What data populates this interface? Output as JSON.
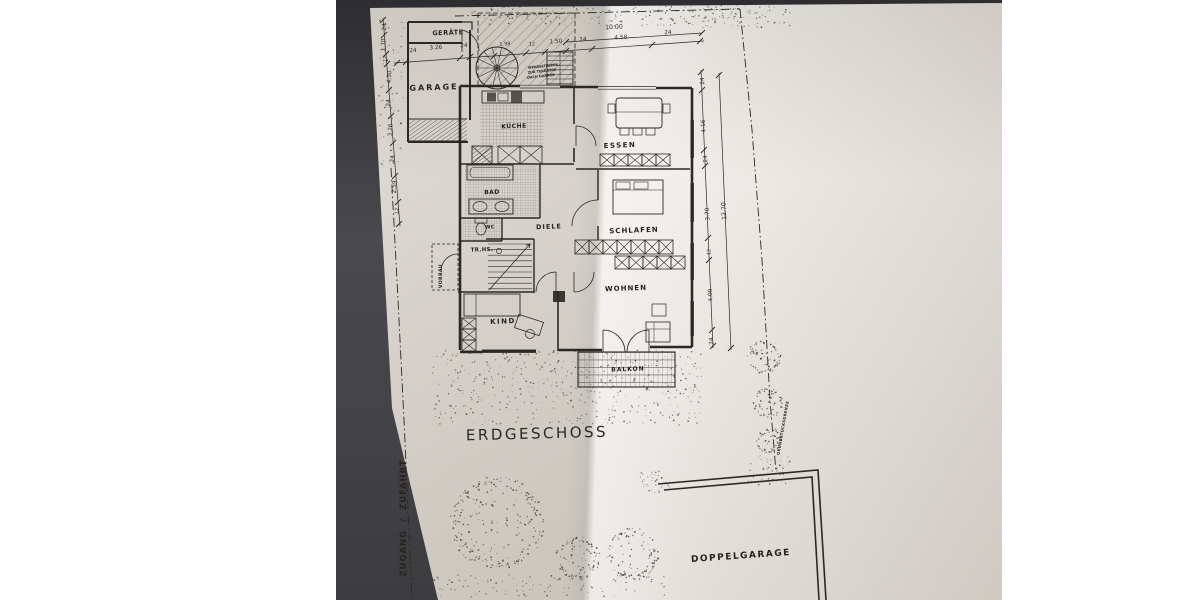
{
  "title": {
    "text": "ERDGESCHOSS"
  },
  "ink_color": "#2b2924",
  "paper_color": "#e7e4de",
  "room_labels": [
    {
      "id": "geraete",
      "text": "GERÄTE",
      "x": 448,
      "y": 33,
      "fs": 6.5,
      "rot": -2,
      "ls": 0.5
    },
    {
      "id": "garage",
      "text": "GARAGE",
      "x": 434,
      "y": 88,
      "fs": 8,
      "rot": -2,
      "ls": 2
    },
    {
      "id": "kueche",
      "text": "KÜCHE",
      "x": 514,
      "y": 127,
      "fs": 6,
      "rot": -2,
      "ls": 0.5
    },
    {
      "id": "essen",
      "text": "ESSEN",
      "x": 620,
      "y": 146,
      "fs": 7,
      "rot": -2,
      "ls": 1.5
    },
    {
      "id": "bad",
      "text": "BAD",
      "x": 492,
      "y": 193,
      "fs": 6,
      "rot": -2,
      "ls": 0.5
    },
    {
      "id": "wc",
      "text": "WC",
      "x": 490,
      "y": 228,
      "fs": 5,
      "rot": -2,
      "ls": 0.3
    },
    {
      "id": "diele",
      "text": "DIELE",
      "x": 549,
      "y": 227,
      "fs": 6.5,
      "rot": -2,
      "ls": 1
    },
    {
      "id": "treppenhaus",
      "text": "TR.HS.",
      "x": 482,
      "y": 251,
      "fs": 5.5,
      "rot": -2,
      "ls": 0.3
    },
    {
      "id": "schlafen",
      "text": "SCHLAFEN",
      "x": 634,
      "y": 231,
      "fs": 7,
      "rot": -2,
      "ls": 1
    },
    {
      "id": "wohnen",
      "text": "WOHNEN",
      "x": 626,
      "y": 289,
      "fs": 7,
      "rot": -2,
      "ls": 1
    },
    {
      "id": "kind",
      "text": "KIND",
      "x": 503,
      "y": 322,
      "fs": 7,
      "rot": -2,
      "ls": 1.5
    },
    {
      "id": "balkon",
      "text": "BALKON",
      "x": 628,
      "y": 370,
      "fs": 6,
      "rot": -2,
      "ls": 1
    },
    {
      "id": "vorbau",
      "text": "VORBAU",
      "x": 442,
      "y": 276,
      "fs": 4.5,
      "rot": -90,
      "ls": 0.5
    },
    {
      "id": "doppelgarage",
      "text": "DOPPELGARAGE",
      "x": 741,
      "y": 557,
      "fs": 9,
      "rot": -4,
      "ls": 1.5
    },
    {
      "id": "zugang-zufahrt",
      "text": "ZUGANG  /  ZUFAHRT",
      "x": 404,
      "y": 518,
      "fs": 8.5,
      "rot": -90,
      "ls": 1
    },
    {
      "id": "grundstuecksgrenze",
      "text": "GRUNDSTÜCKSGRENZE",
      "x": 783,
      "y": 428,
      "fs": 3.8,
      "rot": -80,
      "ls": 0.3
    },
    {
      "id": "wendeltreppe-1",
      "text": "WENDELTREPPE",
      "x": 543,
      "y": 67,
      "fs": 3.4,
      "rot": -6,
      "ls": 0
    },
    {
      "id": "wendeltreppe-2",
      "text": "ZUR TERRASSE",
      "x": 542,
      "y": 72,
      "fs": 3.4,
      "rot": -6,
      "ls": 0
    },
    {
      "id": "wendeltreppe-3",
      "text": "DACH GARAGE",
      "x": 541,
      "y": 77,
      "fs": 3.4,
      "rot": -6,
      "ls": 0
    }
  ],
  "dim_labels": [
    {
      "text": "10.00",
      "x": 614,
      "y": 28,
      "fs": 6.2,
      "rot": -3
    },
    {
      "text": "24",
      "x": 413,
      "y": 52,
      "fs": 5.8,
      "rot": -3
    },
    {
      "text": "3.26",
      "x": 436,
      "y": 49,
      "fs": 5.8,
      "rot": -3
    },
    {
      "text": "24",
      "x": 464,
      "y": 47,
      "fs": 5.8,
      "rot": -3
    },
    {
      "text": "1.98",
      "x": 505,
      "y": 45,
      "fs": 5,
      "rot": -3
    },
    {
      "text": "12",
      "x": 532,
      "y": 45,
      "fs": 5,
      "rot": -3
    },
    {
      "text": "1.50",
      "x": 556,
      "y": 43,
      "fs": 5.8,
      "rot": -3
    },
    {
      "text": "24",
      "x": 583,
      "y": 41,
      "fs": 5.8,
      "rot": -3
    },
    {
      "text": "4.58",
      "x": 621,
      "y": 39,
      "fs": 5.8,
      "rot": -3
    },
    {
      "text": "24",
      "x": 668,
      "y": 34,
      "fs": 5.8,
      "rot": -3
    },
    {
      "text": "24",
      "x": 386,
      "y": 27,
      "fs": 5.8,
      "rot": -87
    },
    {
      "text": "1.70",
      "x": 385,
      "y": 45,
      "fs": 5.8,
      "rot": -87
    },
    {
      "text": "12",
      "x": 386,
      "y": 59,
      "fs": 5,
      "rot": -87
    },
    {
      "text": "4.30",
      "x": 391,
      "y": 77,
      "fs": 5.8,
      "rot": -87
    },
    {
      "text": "24",
      "x": 390,
      "y": 103,
      "fs": 5.8,
      "rot": -87
    },
    {
      "text": "3.26",
      "x": 392,
      "y": 130,
      "fs": 5.8,
      "rot": -87
    },
    {
      "text": "24",
      "x": 394,
      "y": 159,
      "fs": 5.8,
      "rot": -87
    },
    {
      "text": "2.59",
      "x": 396,
      "y": 187,
      "fs": 5.8,
      "rot": -87
    },
    {
      "text": "12",
      "x": 398,
      "y": 211,
      "fs": 5,
      "rot": -87
    },
    {
      "text": "24",
      "x": 704,
      "y": 81,
      "fs": 5.8,
      "rot": -93
    },
    {
      "text": "4.16",
      "x": 705,
      "y": 126,
      "fs": 5.8,
      "rot": -93
    },
    {
      "text": "24",
      "x": 707,
      "y": 159,
      "fs": 5.8,
      "rot": -93
    },
    {
      "text": "3.70",
      "x": 709,
      "y": 214,
      "fs": 5.8,
      "rot": -93
    },
    {
      "text": "12",
      "x": 710,
      "y": 252,
      "fs": 5,
      "rot": -93
    },
    {
      "text": "4.00",
      "x": 712,
      "y": 295,
      "fs": 5.8,
      "rot": -93
    },
    {
      "text": "24",
      "x": 713,
      "y": 341,
      "fs": 5.8,
      "rot": -93
    },
    {
      "text": "12.70",
      "x": 725,
      "y": 211,
      "fs": 6.2,
      "rot": -93
    }
  ]
}
